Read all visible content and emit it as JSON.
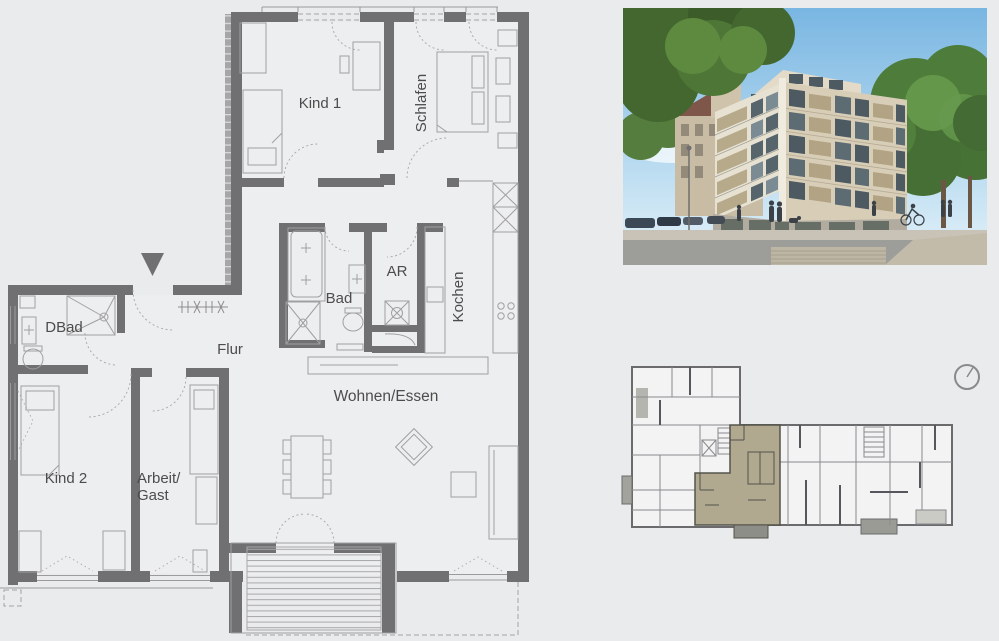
{
  "document": {
    "type": "apartment-floor-plan-sheet"
  },
  "floor_plan": {
    "labels": {
      "kind1": "Kind 1",
      "schlafen": "Schlafen",
      "bad": "Bad",
      "ar": "AR",
      "kochen": "Kochen",
      "dbad": "DBad",
      "flur": "Flur",
      "kind2": "Kind 2",
      "arbeit_line1": "Arbeit/",
      "arbeit_line2": "Gast",
      "wohnen": "Wohnen/Essen"
    },
    "colors": {
      "wall": "#707073",
      "furniture_line": "#a0a0a2",
      "background": "#eaebec",
      "label_text": "#4c4c4c"
    }
  },
  "key_plan": {
    "highlighted_unit_color": "#b1a98f",
    "balcony_color": "#8e8e88",
    "outline_color": "#6b6b6d"
  },
  "photo": {
    "colors": {
      "sky": "#86bfe5",
      "trees": "#44672f",
      "facade_front": "#e7e1d2",
      "facade_side": "#d8ceb7",
      "balcony_panels": "#b1a383",
      "ground_floor": "#b1aba0",
      "street": "#9d9d9a"
    }
  }
}
